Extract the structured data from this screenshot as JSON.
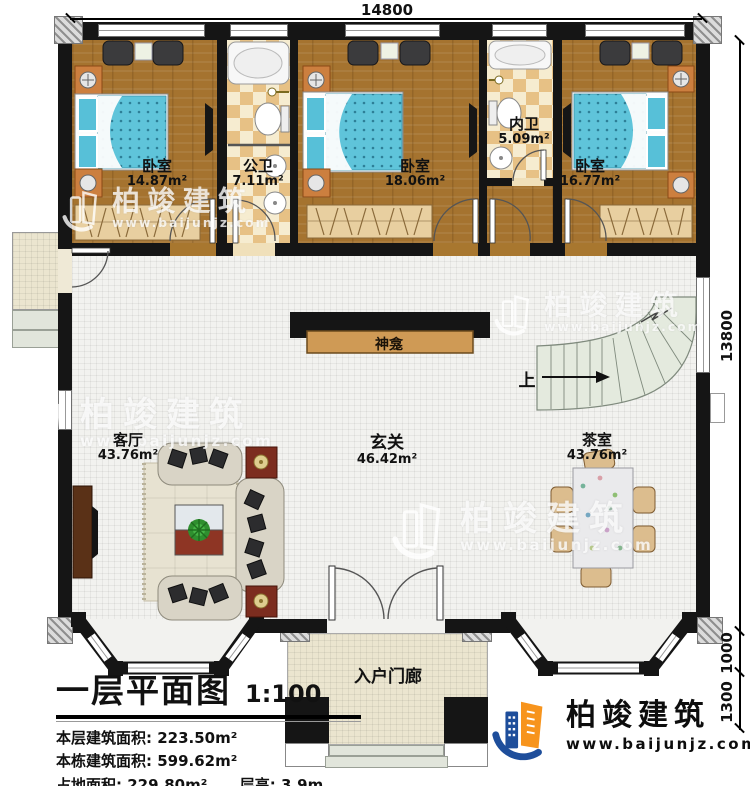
{
  "dimensions": {
    "top_width": "14800",
    "right_height": "13800",
    "right_lower1": "1000",
    "right_lower2": "1300"
  },
  "rooms": {
    "bedroom1": {
      "name": "卧室",
      "area": "14.87m²"
    },
    "public_bath": {
      "name": "公卫",
      "area": "7.11m²"
    },
    "bedroom2": {
      "name": "卧室",
      "area": "18.06m²"
    },
    "inner_bath": {
      "name": "内卫",
      "area": "5.09m²"
    },
    "bedroom3": {
      "name": "卧室",
      "area": "16.77m²"
    },
    "living_room": {
      "name": "客厅",
      "area": "43.76m²"
    },
    "foyer": {
      "name": "玄关",
      "area": "46.42m²"
    },
    "tea_room": {
      "name": "茶室",
      "area": "43.76m²"
    },
    "entry_porch": {
      "name": "入户门廊"
    }
  },
  "features": {
    "shrine": "神龛",
    "stairs_up": "上"
  },
  "title_block": {
    "title": "一层平面图",
    "scale": "1:100",
    "line1_label": "本层建筑面积:",
    "line1_value": "223.50m²",
    "line2_label": "本栋建筑面积:",
    "line2_value": "599.62m²",
    "line3_label": "占地面积:",
    "line3_value": "229.80m²",
    "line4_label": "层高:",
    "line4_value": "3.9m"
  },
  "branding": {
    "company": "柏竣建筑",
    "website": "www.baijunjz.com"
  },
  "colors": {
    "wall": "#151515",
    "wood_floor": "#a5732f",
    "bath_checker": "#e7c185",
    "stairs": "#e4eade",
    "brand_blue": "#1e4e9b",
    "brand_orange": "#f7941d"
  }
}
